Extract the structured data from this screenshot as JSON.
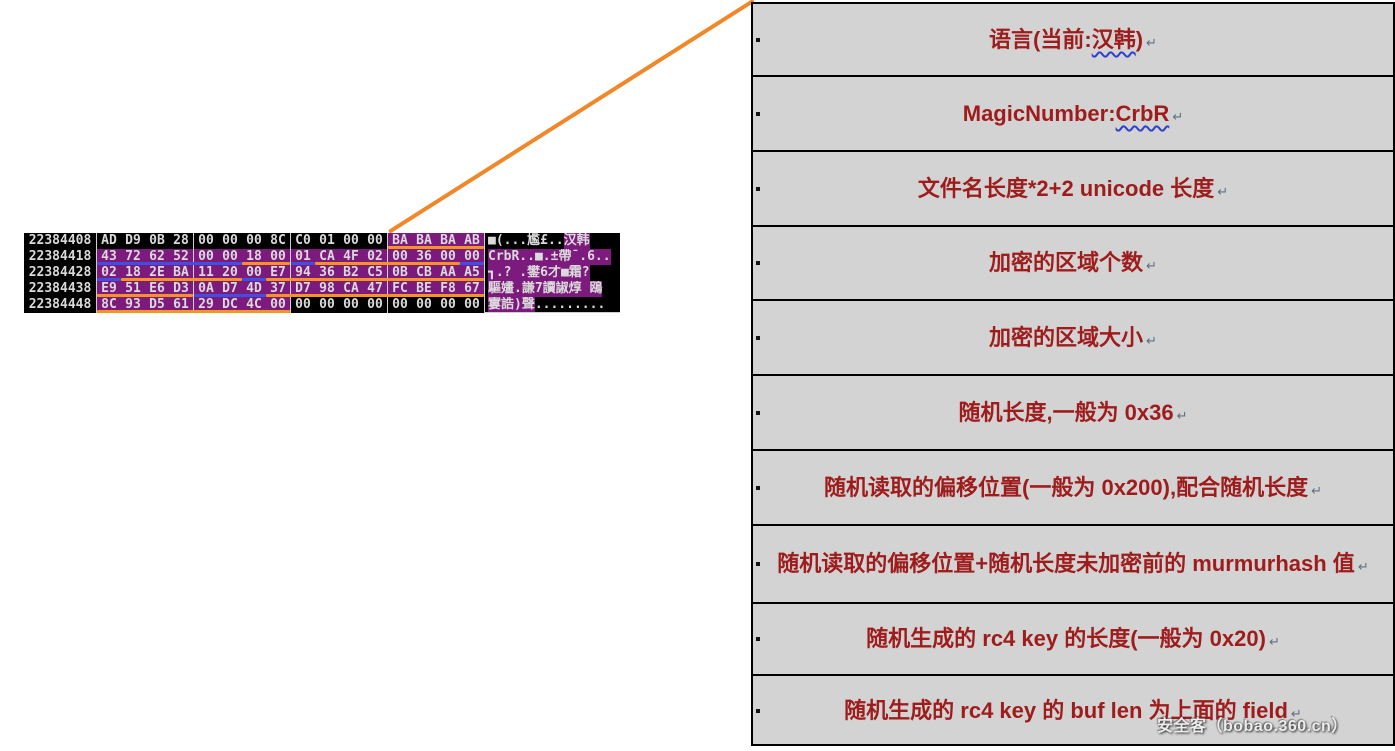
{
  "colors": {
    "highlight_purple": "#7d1a7d",
    "underline_orange": "#f7941d",
    "underline_blue": "#3f4fe0",
    "connector_orange": "#f0882a",
    "table_background": "#d3d3d3",
    "table_text_red": "#9e1c1c",
    "hex_background": "#000000",
    "hex_text": "#dadada"
  },
  "hexdump": {
    "rows": [
      {
        "addr": "22384408",
        "bytes": [
          "AD",
          "D9",
          "0B",
          "28",
          "00",
          "00",
          "00",
          "8C",
          "C0",
          "01",
          "00",
          "00",
          "BA",
          "BA",
          "BA",
          "AB"
        ],
        "hl": [
          12,
          15
        ],
        "ascii_pre": "■(...尷£..",
        "ascii_hi": "汉韩",
        "ascii_post": "",
        "underlines": [
          {
            "s": 12,
            "e": 15,
            "c": "orange"
          }
        ]
      },
      {
        "addr": "22384418",
        "bytes": [
          "43",
          "72",
          "62",
          "52",
          "00",
          "00",
          "18",
          "00",
          "01",
          "CA",
          "4F",
          "02",
          "00",
          "36",
          "00",
          "00"
        ],
        "hl": [
          0,
          15
        ],
        "ascii_pre": "",
        "ascii_hi": "CrbR..■.±帶¯.6..",
        "ascii_post": "",
        "underlines": [
          {
            "s": 0,
            "e": 5,
            "c": "blue"
          },
          {
            "s": 6,
            "e": 7,
            "c": "orange"
          },
          {
            "s": 8,
            "e": 8,
            "c": "blue"
          },
          {
            "s": 9,
            "e": 14,
            "c": "orange"
          },
          {
            "s": 15,
            "e": 15,
            "c": "blue"
          }
        ]
      },
      {
        "addr": "22384428",
        "bytes": [
          "02",
          "18",
          "2E",
          "BA",
          "11",
          "20",
          "00",
          "E7",
          "94",
          "36",
          "B2",
          "C5",
          "0B",
          "CB",
          "AA",
          "A5"
        ],
        "hl": [
          0,
          15
        ],
        "ascii_pre": "",
        "ascii_hi": "┓.? .鐢6才■霜?",
        "ascii_post": "",
        "underlines": [
          {
            "s": 0,
            "e": 0,
            "c": "blue"
          },
          {
            "s": 1,
            "e": 5,
            "c": "orange"
          },
          {
            "s": 6,
            "e": 6,
            "c": "blue"
          },
          {
            "s": 7,
            "e": 15,
            "c": "orange"
          }
        ]
      },
      {
        "addr": "22384438",
        "bytes": [
          "E9",
          "51",
          "E6",
          "D3",
          "0A",
          "D7",
          "4D",
          "37",
          "D7",
          "98",
          "CA",
          "47",
          "FC",
          "BE",
          "F8",
          "67"
        ],
        "hl": [
          0,
          15
        ],
        "ascii_pre": "",
        "ascii_hi": "驅嫿.謙7讀諔焞 鴎",
        "ascii_post": "",
        "underlines": [
          {
            "s": 0,
            "e": 3,
            "c": "orange"
          },
          {
            "s": 4,
            "e": 6,
            "c": "blue"
          },
          {
            "s": 7,
            "e": 15,
            "c": "orange"
          }
        ]
      },
      {
        "addr": "22384448",
        "bytes": [
          "8C",
          "93",
          "D5",
          "61",
          "29",
          "DC",
          "4C",
          "00",
          "00",
          "00",
          "00",
          "00",
          "00",
          "00",
          "00",
          "00"
        ],
        "hl": [
          0,
          7
        ],
        "ascii_pre": "",
        "ascii_hi": "寠誥)聲",
        "ascii_post": ".........",
        "underlines": [
          {
            "s": 0,
            "e": 7,
            "c": "orange"
          }
        ]
      }
    ]
  },
  "table": {
    "pilcrow": "↵",
    "rows": [
      {
        "pre": "语言(当前:",
        "wavy": "汉韩",
        "post": ")"
      },
      {
        "pre": "MagicNumber:",
        "wavy": "CrbR",
        "post": ""
      },
      {
        "pre": "文件名长度*2+2 unicode 长度",
        "wavy": "",
        "post": ""
      },
      {
        "pre": "加密的区域个数",
        "wavy": "",
        "post": ""
      },
      {
        "pre": "加密的区域大小",
        "wavy": "",
        "post": ""
      },
      {
        "pre": "随机长度,一般为 0x36",
        "wavy": "",
        "post": ""
      },
      {
        "pre": "随机读取的偏移位置(一般为 0x200),配合随机长度",
        "wavy": "",
        "post": ""
      },
      {
        "pre": "随机读取的偏移位置+随机长度未加密前的 murmurhash 值",
        "wavy": "",
        "post": ""
      },
      {
        "pre": "随机生成的 rc4 key 的长度(一般为 0x20)",
        "wavy": "",
        "post": ""
      },
      {
        "pre": "随机生成的 rc4 key 的 buf len 为上面的 field",
        "wavy": "",
        "post": ""
      }
    ]
  },
  "watermark": {
    "text": "安全客（bobao.360.cn）"
  }
}
